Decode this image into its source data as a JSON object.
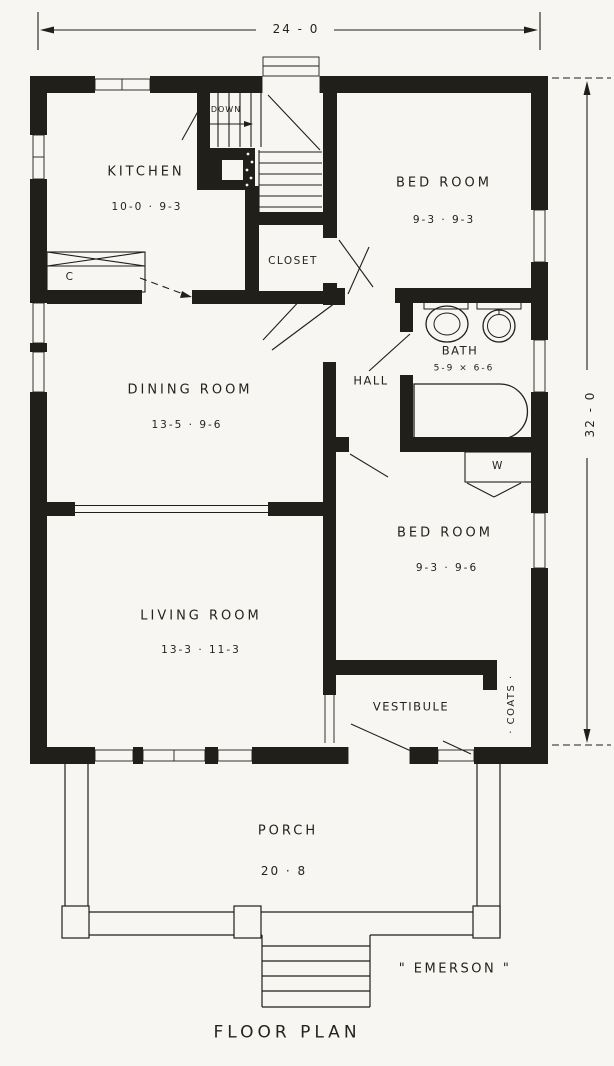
{
  "title": "FLOOR PLAN",
  "signature": "\" EMERSON \"",
  "dimensions": {
    "width": "24 - 0",
    "height": "32 - 0"
  },
  "labels": {
    "down": "DOWN",
    "counter": "C",
    "wardrobe": "W"
  },
  "rooms": {
    "kitchen": {
      "name": "KITCHEN",
      "size": "10-0 · 9-3"
    },
    "bedroom1": {
      "name": "BED ROOM",
      "size": "9-3 · 9-3"
    },
    "closet": {
      "name": "CLOSET"
    },
    "bath": {
      "name": "BATH",
      "size": "5-9 × 6-6"
    },
    "hall": {
      "name": "HALL"
    },
    "dining_room": {
      "name": "DINING ROOM",
      "size": "13-5 · 9-6"
    },
    "bedroom2": {
      "name": "BED ROOM",
      "size": "9-3 · 9-6"
    },
    "living_room": {
      "name": "LIVING ROOM",
      "size": "13-3 · 11-3"
    },
    "vestibule": {
      "name": "VESTIBULE"
    },
    "coats": {
      "name": "· COATS ·"
    },
    "porch": {
      "name": "PORCH",
      "size": "20 · 8"
    }
  },
  "colors": {
    "ink": "#211f1a",
    "paper": "#f7f6f2"
  }
}
